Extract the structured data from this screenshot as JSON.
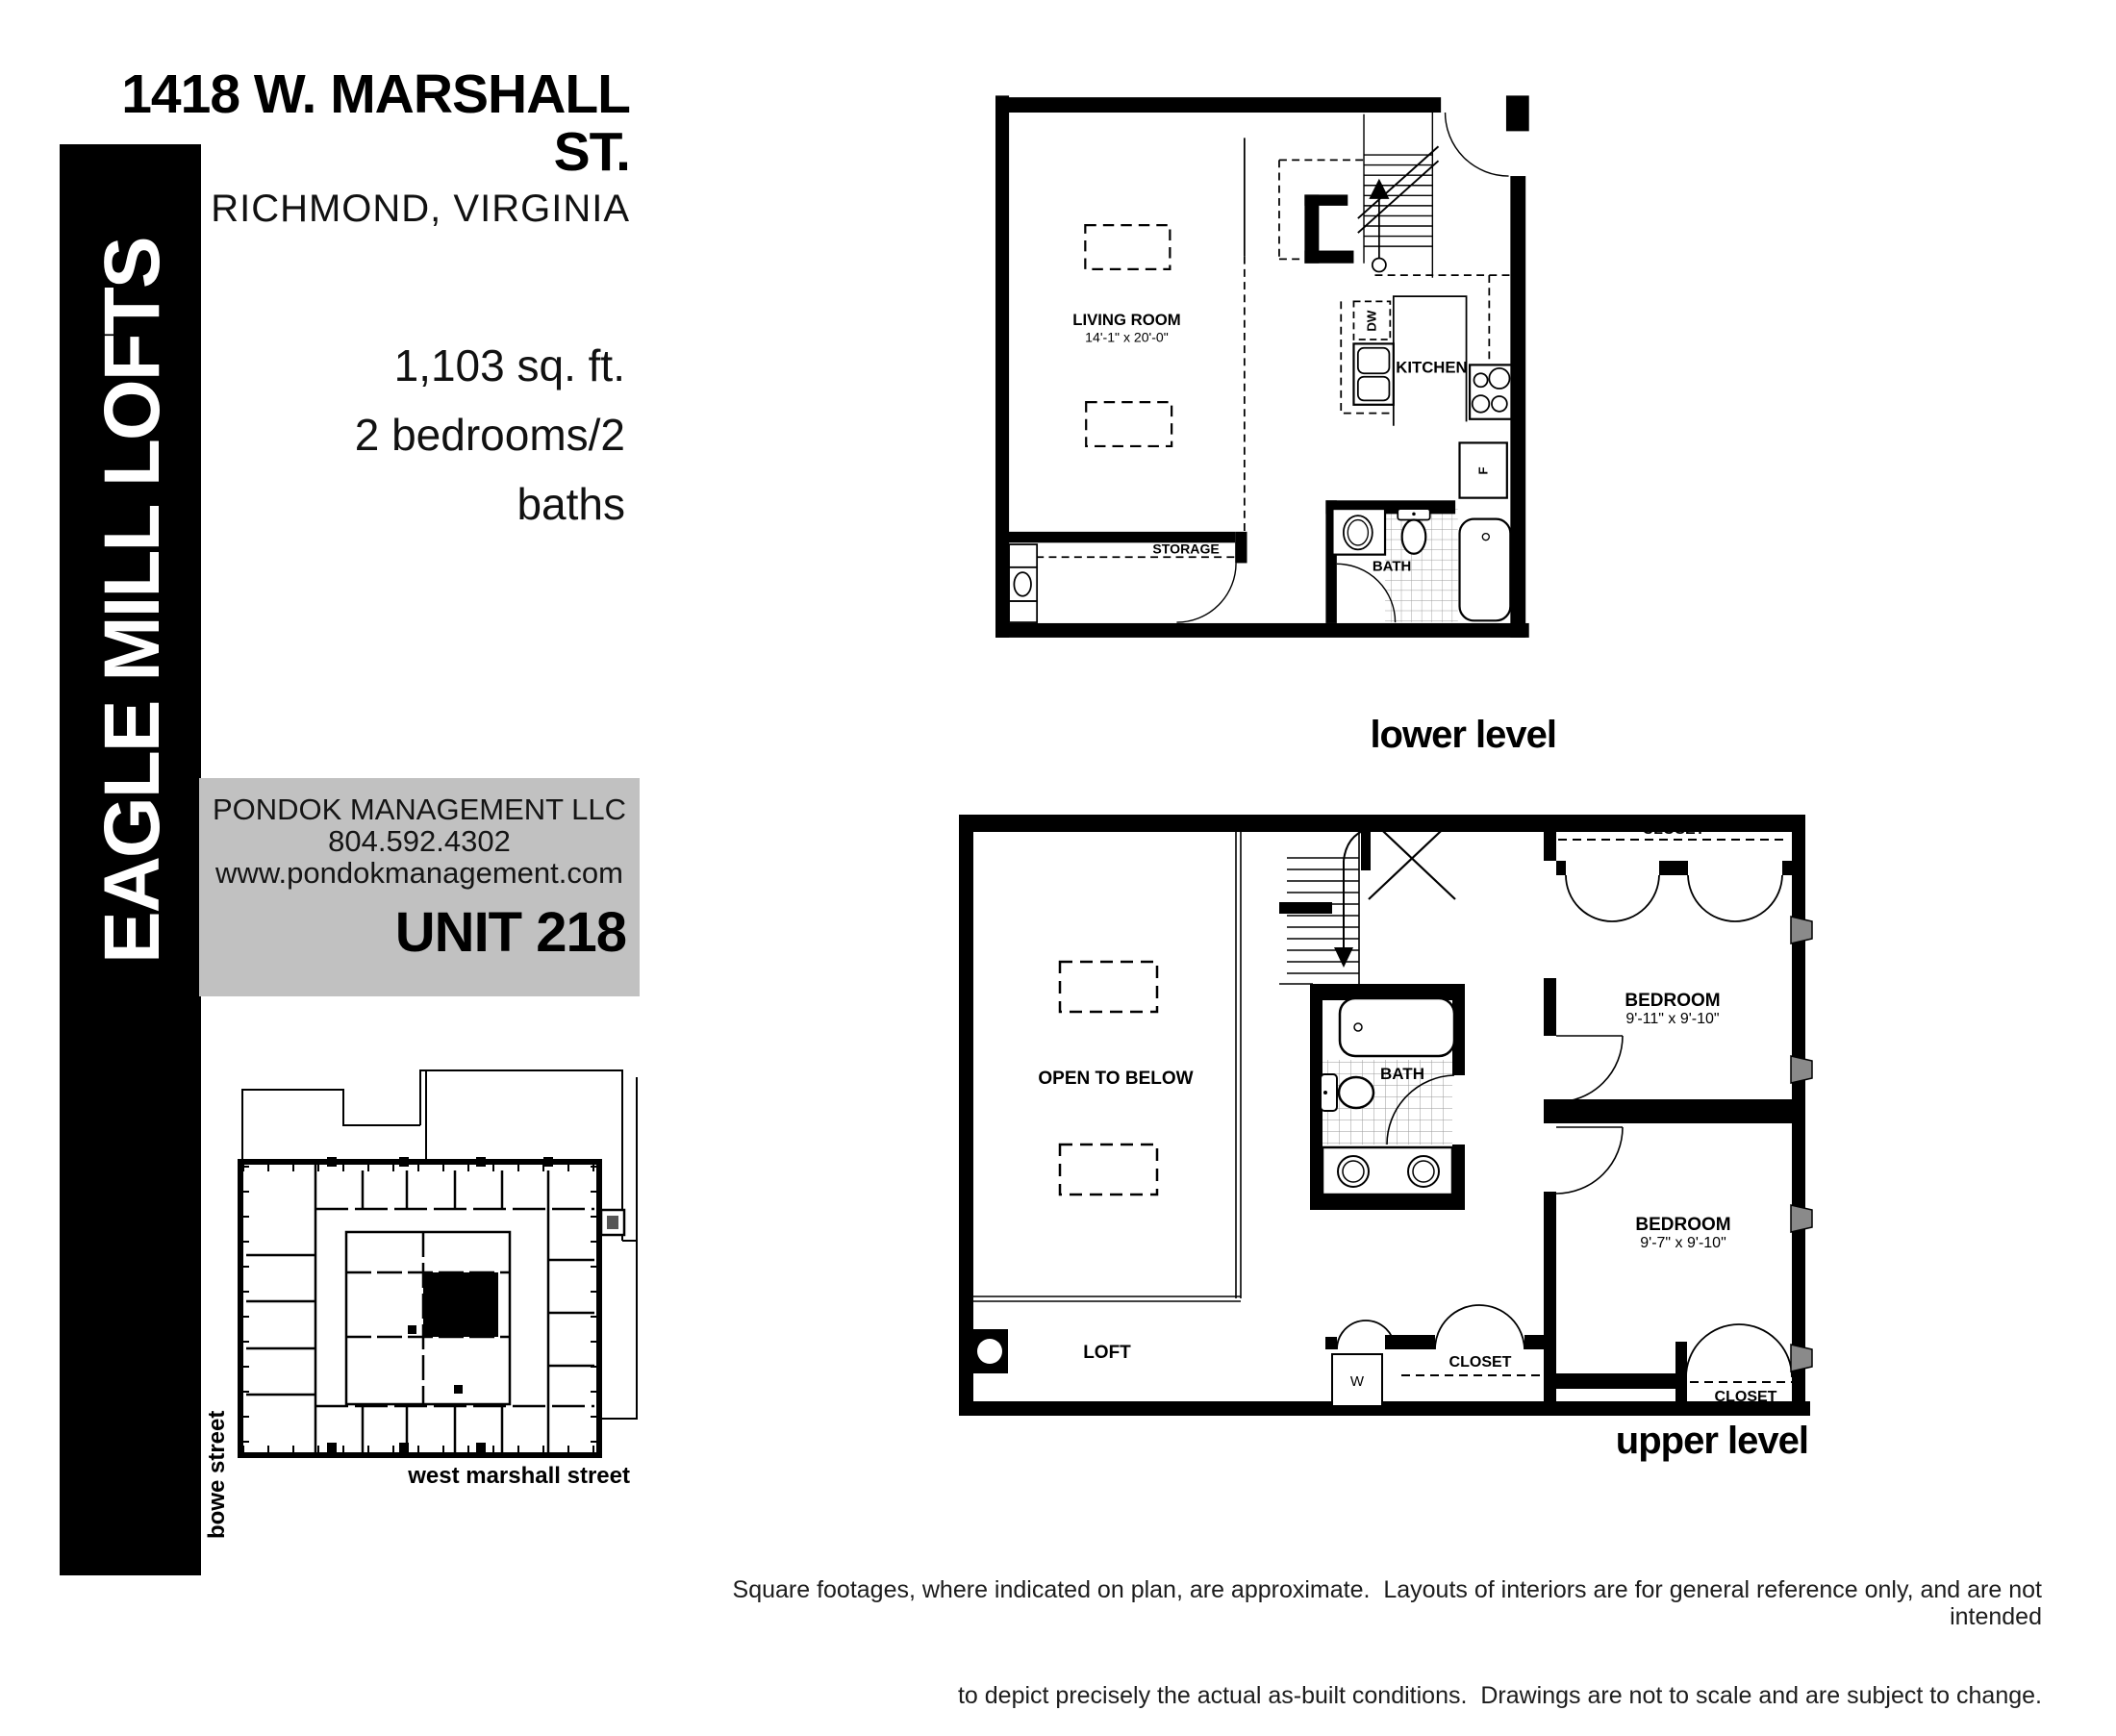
{
  "header": {
    "address": "1418 W. MARSHALL ST.",
    "city": "RICHMOND, VIRGINIA"
  },
  "banner": {
    "text": "EAGLE MILL LOFTS"
  },
  "unit_info": {
    "sqft": "1,103 sq. ft.",
    "beds_baths": "2 bedrooms/2 baths"
  },
  "management": {
    "company": "PONDOK MANAGEMENT LLC",
    "phone": "804.592.4302",
    "website": "www.pondokmanagement.com",
    "unit": "UNIT 218"
  },
  "lower_level": {
    "caption": "lower level",
    "living_room": "LIVING ROOM",
    "living_dims": "14'-1\" x 20'-0\"",
    "kitchen": "KITCHEN",
    "dishwasher": "DW",
    "fridge": "F",
    "storage": "STORAGE",
    "bath": "BATH"
  },
  "upper_level": {
    "caption": "upper level",
    "open_to_below": "OPEN TO BELOW",
    "loft": "LOFT",
    "closet_bedroom1": "CLOSET",
    "bedroom1": "BEDROOM",
    "bedroom1_dims": "9'-11\" x 9'-10\"",
    "bath": "BATH",
    "bedroom2": "BEDROOM",
    "bedroom2_dims": "9'-7\" x 9'-10\"",
    "washer": "W",
    "closet_hall": "CLOSET",
    "closet_bedroom2": "CLOSET"
  },
  "site_plan": {
    "street_left": "bowe street",
    "street_bottom": "west marshall street"
  },
  "disclaimer": {
    "line1": "Square footages, where indicated on plan, are approximate.  Layouts of interiors are for general reference only, and are not intended",
    "line2": "to depict precisely the actual as-built conditions.  Drawings are not to scale and are subject to change."
  },
  "colors": {
    "box_gray": "#c1c1c1",
    "ink": "#000000"
  }
}
